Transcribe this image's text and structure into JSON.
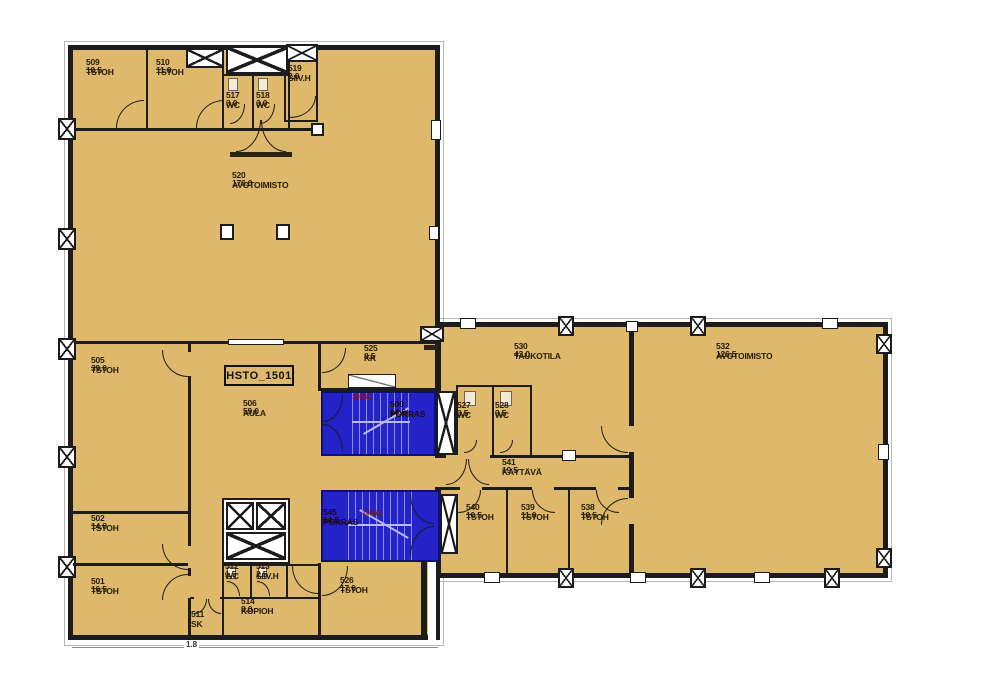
{
  "plan": {
    "unit_label": "HSTO_1501",
    "bottom_dimension": "1.8"
  },
  "colors": {
    "floor": "#deb96c",
    "stair_blue": "#2323c9",
    "wall": "#1c1c1c"
  },
  "rooms": {
    "r509": {
      "name": "509\nTSTOH",
      "area": "10.5"
    },
    "r510": {
      "name": "510\nTSTOH",
      "area": "11.0"
    },
    "r517": {
      "name": "517\nWC",
      "area": "3.0"
    },
    "r518": {
      "name": "518\nWC",
      "area": "3.0"
    },
    "r519": {
      "name": "519\nSIIV.H",
      "area": "2.0"
    },
    "r520": {
      "name": "520\nAVOTOIMISTO",
      "area": "176.0"
    },
    "r505": {
      "name": "505\nTSTOH",
      "area": "39.0"
    },
    "r506": {
      "name": "506\nAULA",
      "area": "59.0"
    },
    "r525": {
      "name": "525\nKK",
      "area": "8.5"
    },
    "r502": {
      "name": "502\nTSTOH",
      "area": "14.0"
    },
    "r501": {
      "name": "501\nTSTOH",
      "area": "16.5"
    },
    "r511": {
      "name": "511\nSK",
      "area": ""
    },
    "r512": {
      "name": "512\nWC",
      "area": "1.5"
    },
    "r513": {
      "name": "513\nSIIV.H",
      "area": "2.5"
    },
    "r514": {
      "name": "514\nKOPIOH",
      "area": "8.0"
    },
    "r526": {
      "name": "526\nTSTOH",
      "area": "17.0"
    },
    "r527": {
      "name": "527\nWC",
      "area": "3.5"
    },
    "r528": {
      "name": "528\nWC",
      "area": "3.5"
    },
    "r530": {
      "name": "530\nTAUKOTILA",
      "area": "43.0"
    },
    "r532": {
      "name": "532\nAVOTOIMISTO",
      "area": "126.5"
    },
    "r541": {
      "name": "541\nKÄYTÄVÄ",
      "area": "19.5"
    },
    "r540": {
      "name": "540\nTSTOH",
      "area": "10.5"
    },
    "r539": {
      "name": "539\nTSTOH",
      "area": "11.0"
    },
    "r538": {
      "name": "538\nTSTOH",
      "area": "10.5"
    },
    "s500": {
      "name": "500\nPORRAS",
      "area": "14.0",
      "id": "10162"
    },
    "s545": {
      "name": "545\nPORRAS",
      "area": "14.5",
      "id": "10161"
    }
  }
}
